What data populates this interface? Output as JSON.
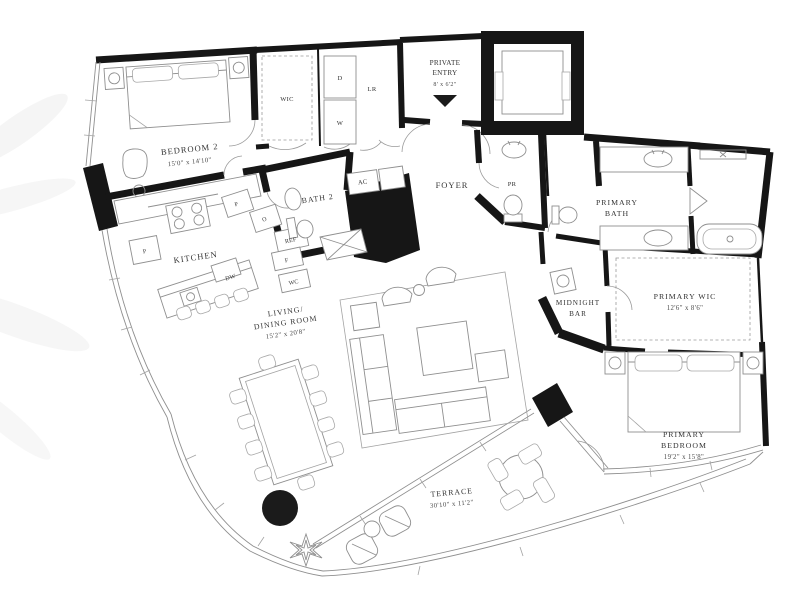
{
  "plan_type": "floor-plan",
  "colors": {
    "wall": "#161616",
    "furniture_line": "#8f8f8f",
    "label_text": "#343434",
    "background": "#ffffff"
  },
  "rooms": {
    "bedroom2": {
      "label": "BEDROOM 2",
      "dims": "15'0\" x 14'10\""
    },
    "wic": {
      "label": "WIC"
    },
    "laundry": {
      "dryer": "D",
      "washer": "W",
      "linen": "LR"
    },
    "private_entry": {
      "line1": "PRIVATE",
      "line2": "ENTRY",
      "dims": "8' x 6'2\""
    },
    "bath2": {
      "label": "BATH 2"
    },
    "ac": {
      "label": "AC"
    },
    "foyer": {
      "label": "FOYER"
    },
    "powder_room": {
      "label": "PR"
    },
    "primary_bath": {
      "line1": "PRIMARY",
      "line2": "BATH"
    },
    "kitchen": {
      "label": "KITCHEN",
      "appliances": {
        "pantry_upper": "P",
        "oven": "O",
        "refrigerator": "REF",
        "freezer": "F",
        "wine_cooler": "WC",
        "dishwasher": "DW",
        "pantry_lower": "P"
      }
    },
    "living_dining": {
      "line1": "LIVING/",
      "line2": "DINING ROOM",
      "dims": "15'2\" x 20'8\""
    },
    "midnight_bar": {
      "line1": "MIDNIGHT",
      "line2": "BAR"
    },
    "primary_wic": {
      "label": "PRIMARY WIC",
      "dims": "12'6\" x 8'6\""
    },
    "primary_bedroom": {
      "line1": "PRIMARY",
      "line2": "BEDROOM",
      "dims": "19'2\" x 15'8\""
    },
    "terrace": {
      "label": "TERRACE",
      "dims": "30'10\" x 11'2\""
    }
  }
}
